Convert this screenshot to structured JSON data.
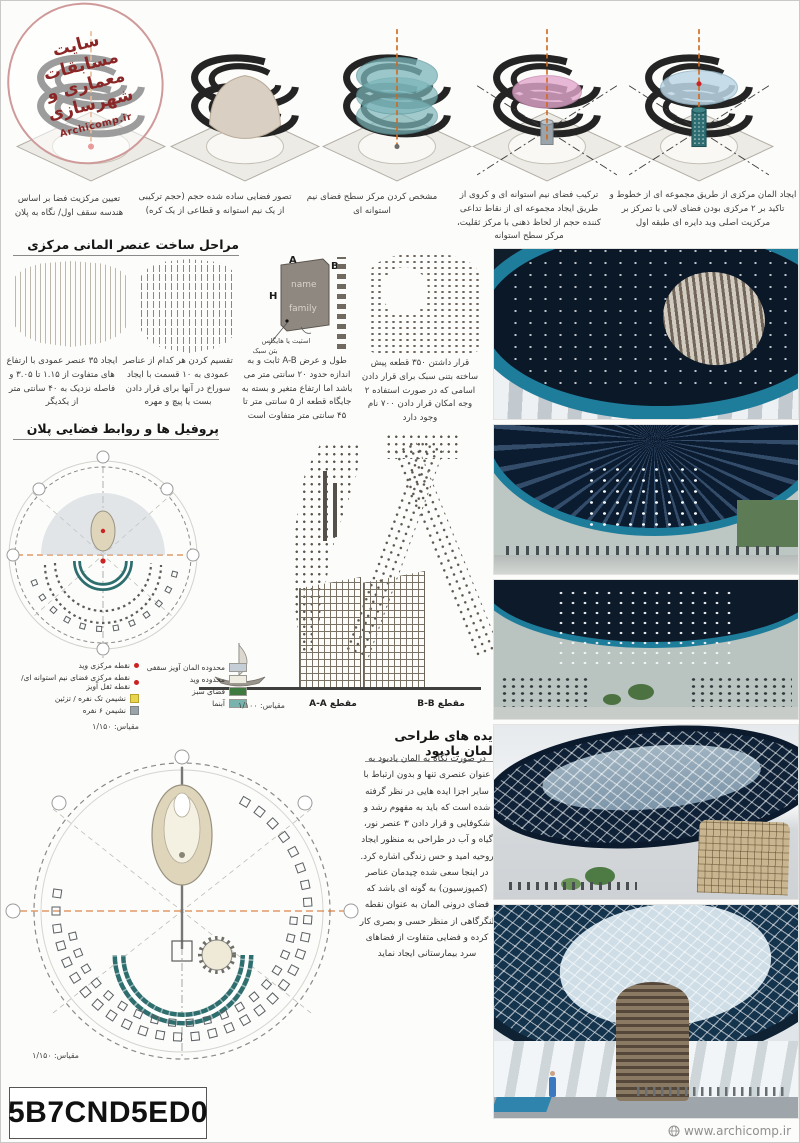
{
  "colors": {
    "accent_orange": "#d2691e",
    "ring_teal": "#1f7d9c",
    "navy": "#0d1e33",
    "stamp_red": "#8b2626",
    "legend_green": "#3e7a40",
    "legend_teal": "#79b3ad",
    "dot_red": "#cc2222"
  },
  "stamp": {
    "line1": "سایت",
    "line2": "مسابقات",
    "line3": "معماری و",
    "line4": "شهرسازی",
    "site": "Archicomp.ir"
  },
  "headers": {
    "process": "مراحل ساخت عنصر المانی مرکزی",
    "profiles": "پروفیل ها و روابط فضایی پلان",
    "ideas": "ایده های طراحی المان یادبود"
  },
  "top_steps": {
    "captions": [
      "تعیین مرکزیت فضا بر اساس هندسه سقف اول/ نگاه به پلان",
      "تصور فضایی ساده شده حجم (حجم ترکیبی از یک نیم استوانه و قطاعی از یک کره)",
      "مشخص کردن مرکز سطح فضای نیم استوانه ای",
      "ترکیب فضای نیم استوانه ای و کروی از طریق ایجاد مجموعه ای از نقاط تداعی کننده حجم از لحاظ ذهنی با مرکز ثقلیت، مرکز سطح استوانه",
      "ایجاد المان مرکزی از طریق مجموعه ای از خطوط و تاکید بر ۲ مرکزی بودن فضای لابی با تمرکز بر مرکزیت اصلی وید دایره ای طبقه اول"
    ]
  },
  "element_steps": {
    "captions": [
      "ایجاد ۳۵ عنصر عمودی با ارتفاع های متفاوت از ۱.۱۵ تا ۳.۰۵ و فاصله نزدیک به ۴۰ سانتی متر از یکدیگر",
      "تقسیم کردن هر کدام از عناصر عمودی به ۱۰ قسمت با ایجاد سوراخ در آنها برای قرار دادن بست یا پیچ و مهره",
      "طول و عرض A-B ثابت و به اندازه حدود ۲۰ سانتی متر می باشد اما ارتفاع متغیر و بسته به جایگاه قطعه از ۵ سانتی متر تا ۴۵ سانتی متر متفاوت است",
      "قرار داشتن ۳۵۰ قطعه پیش ساخته بتنی سبک برای قرار دادن اسامی که در صورت استفاده ۲ وجه امکان قرار دادن ۷۰۰ نام وجود دارد"
    ],
    "detail": {
      "label_a": "A",
      "label_b": "B",
      "label_h": "H",
      "name": "name",
      "family": "family",
      "note_fastener": "استیت یا هایگلس",
      "note_concrete": "بتن سبک"
    }
  },
  "plan_legend": {
    "items": [
      "نقطه مرکزی وید",
      "نقطه مرکزی فضای نیم استوانه ای/ نقطه ثقل آویز",
      "نشیمن تک نفره / تزئین",
      "نشیمن ۶ نفره"
    ],
    "scale": "مقیاس: ۱/۱۵۰"
  },
  "zones_legend": {
    "items": [
      "محدوده المان آویز سقفی",
      "محدوده وید",
      "فضای سبز",
      "آبنما"
    ]
  },
  "sections": {
    "section_a": "مقطع A-A",
    "section_b": "مقطع B-B",
    "scale": "مقیاس: ۱/۱۰۰"
  },
  "ideas_text": "در صورت نگاه به المان یادبود به عنوان عنصری تنها و بدون ارتباط با سایر اجزا ایده هایی در نظر گرفته شده است که باید به مفهوم رشد و شکوفایی و قرار دادن ۳ عنصر نور، گیاه و آب در طراحی به منظور ایجاد روحیه امید و حس زندگی اشاره کرد. در اینجا سعی شده چیدمان عناصر (کمپوزسیون) به گونه ای باشد که فضای درونی المان به عنوان نقطه لنگرگاهی از منظر حسی و بصری کار کرده و فضایی متفاوت از فضاهای سرد بیمارستانی ایجاد نماید",
  "site_plan": {
    "scale": "مقیاس: ۱/۱۵۰"
  },
  "code_box": {
    "code": "5B7CND5ED0"
  },
  "watermark": {
    "text": "www.archicomp.ir"
  }
}
